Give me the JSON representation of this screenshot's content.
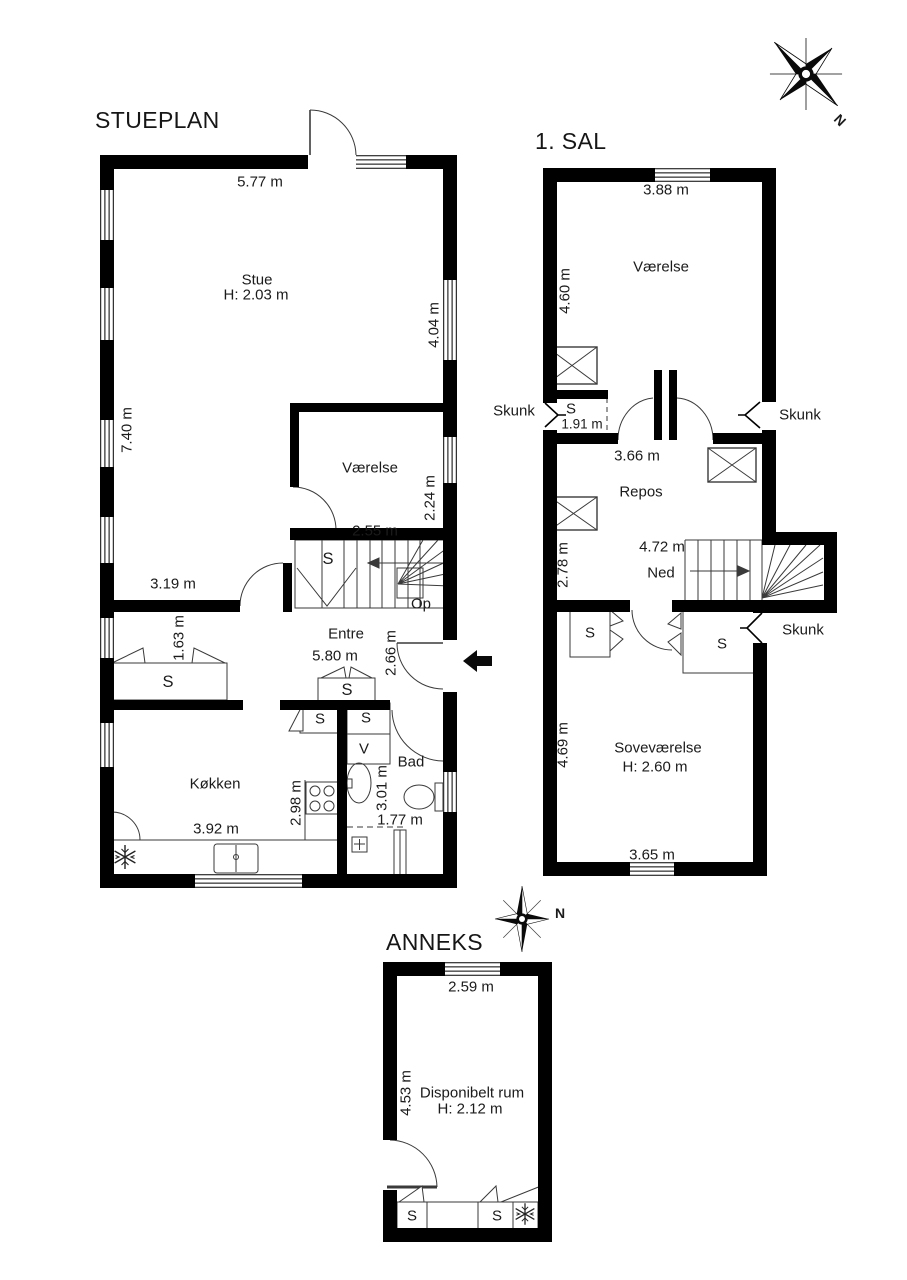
{
  "plan": {
    "compass_label": "N",
    "stueplan": {
      "title": "STUEPLAN",
      "dim_top": "5.77 m",
      "stue_name": "Stue",
      "stue_height": "H: 2.03 m",
      "dim_right": "4.04 m",
      "dim_left": "7.40 m",
      "vaerelse_name": "Værelse",
      "vaerelse_width": "2.55 m",
      "vaerelse_depth": "2.24 m",
      "stair_closet": "S",
      "stair_up": "Op",
      "dim_wall": "3.19 m",
      "closet_left_width": "1.63 m",
      "closet_left_label": "S",
      "entre_name": "Entre",
      "entre_width": "5.80 m",
      "entre_depth": "2.66 m",
      "entre_closet": "S",
      "kitchen_name": "Køkken",
      "kitchen_closet": "S",
      "kitchen_depth": "2.98 m",
      "kitchen_width": "3.92 m",
      "bath_name": "Bad",
      "bath_closet": "S",
      "bath_washer": "V",
      "bath_depth": "3.01 m",
      "bath_width": "1.77 m"
    },
    "sal1": {
      "title": "1. SAL",
      "vaerelse_width": "3.88 m",
      "vaerelse_name": "Værelse",
      "vaerelse_depth": "4.60 m",
      "skunk_left": "Skunk",
      "skunk_right": "Skunk",
      "skunk_lower": "Skunk",
      "closet_label": "S",
      "closet_width": "1.91 m",
      "repos_width": "3.66 m",
      "repos_name": "Repos",
      "repos_depth": "2.78 m",
      "stair_length": "4.72 m",
      "stair_down": "Ned",
      "bedroom_closet_left": "S",
      "bedroom_closet_right": "S",
      "bedroom_name": "Soveværelse",
      "bedroom_height": "H: 2.60 m",
      "bedroom_depth": "4.69 m",
      "bedroom_width": "3.65 m"
    },
    "anneks": {
      "title": "ANNEKS",
      "dim_top": "2.59 m",
      "room_name": "Disponibelt rum",
      "room_height": "H: 2.12 m",
      "dim_left": "4.53 m",
      "closet1": "S",
      "closet2": "S"
    }
  }
}
